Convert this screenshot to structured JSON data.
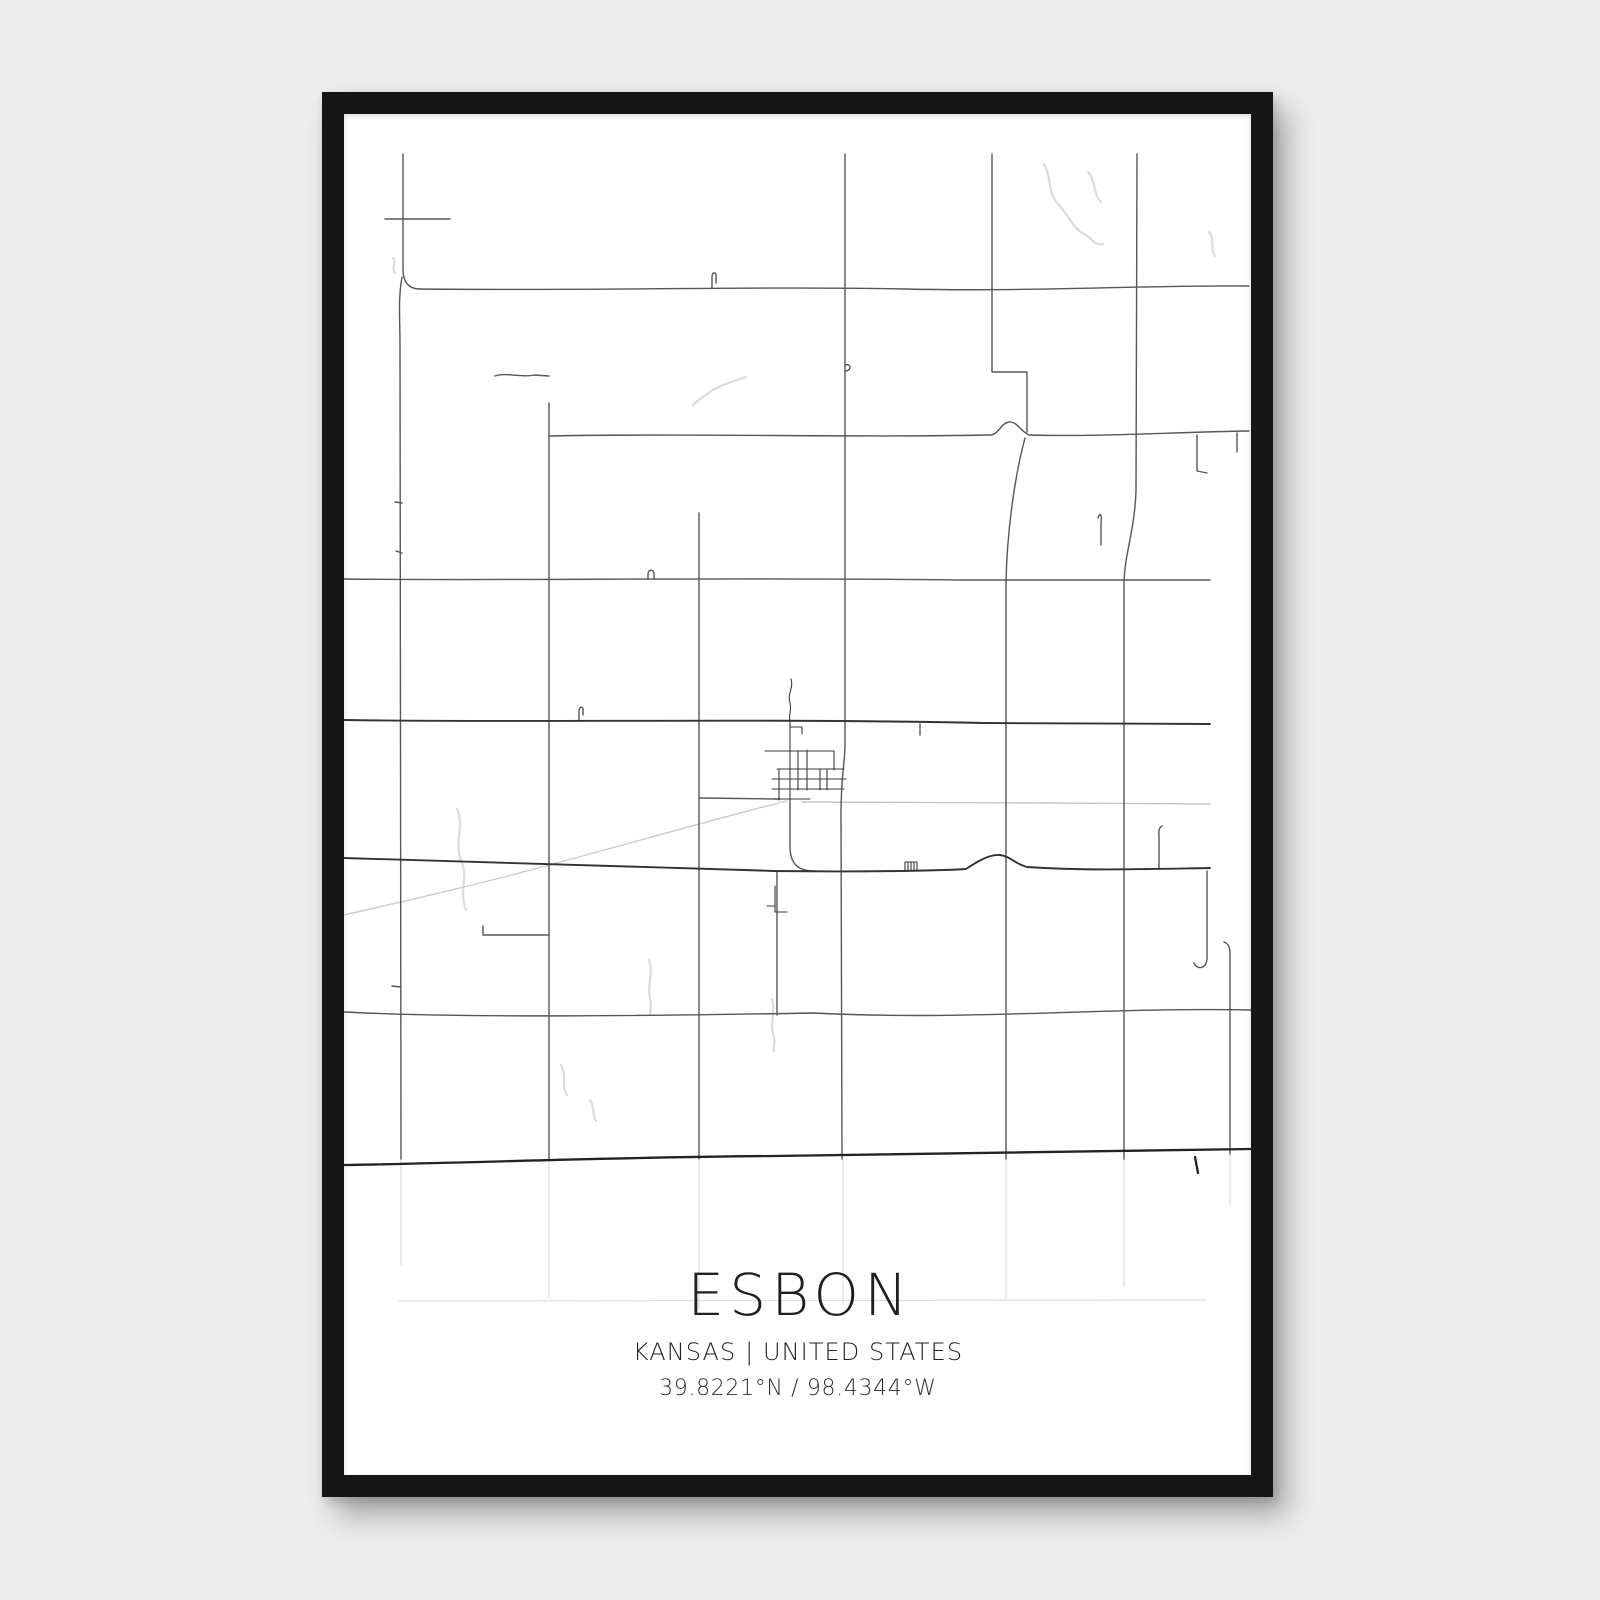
{
  "poster": {
    "title": "ESBON",
    "subtitle": "KANSAS | UNITED STATES",
    "coordinates": "39.8221°N / 98.4344°W"
  },
  "colors": {
    "background": "#ededed",
    "frame": "#161616",
    "print": "#ffffff",
    "text": "#1f1f1f",
    "road": "#565656",
    "road_major": "#232323",
    "road_minor": "#c6c6c6",
    "water": "#dbdbdb"
  },
  "map": {
    "width": 907,
    "height": 1361,
    "layers": [
      {
        "class": "water",
        "paths": [
          "M700,50 C708,64 703,78 714,90 C726,102 728,114 740,120 C748,124 750,132 759,130",
          "M744,58 C752,67 749,80 757,88",
          "M865,118 C871,125 866,135 871,142",
          "M349,291 C356,284 363,280 369,276 C381,269 391,267 402,263",
          "M113,695 C121,712 109,731 118,749 C124,762 115,779 122,796",
          "M428,885 C432,896 425,911 430,923 C432,929 428,933 430,937",
          "M305,846 C310,859 302,873 307,888 L306,901",
          "M217,951 C223,962 217,972 223,981",
          "M246,986 C251,993 248,1001 252,1007",
          "M49,144 C53,149 47,155 51,159"
        ]
      },
      {
        "class": "rail",
        "paths": [
          "M443,687 C380,702 260,737 160,763 C105,777 40,792 0,801"
        ]
      },
      {
        "class": "road-light",
        "paths": [
          "M458,688 L700,689 L866,690"
        ]
      },
      {
        "class": "faint",
        "paths": [
          "M57,1045 L57,1152",
          "M205,1045 L205,1183",
          "M355,1045 L355,1196",
          "M499,1045 L499,1190",
          "M662,1045 L662,1184",
          "M780,1045 L780,1172",
          "M55,1187 L862,1186",
          "M886,1040 L886,1092"
        ]
      },
      {
        "class": "road",
        "paths": [
          "M59,40 L59,155 Q59,175 76,175",
          "M58,163 C54,186 56,202 56,232 L57,1045",
          "M41,105 L106,105",
          "M76,175 C240,177 430,172 560,175 C690,178 800,171 905,172",
          "M205,289 L205,1045",
          "M151,262 C162,258 178,264 190,261 L205,262",
          "M355,399 L355,1045",
          "M205,322 C340,319 520,324 640,321 L647,321 C655,320 657,309 665,308 C673,307 677,318 685,321 C760,323 830,318 905,317",
          "M648,40 L648,258 L683,258 L683,318",
          "M681,324 C670,365 663,420 662,468 L662,1045",
          "M501,40 L501,630 C501,650 497,660 497,700 L498,1045",
          "M793,40 L792,378 C790,420 781,438 780,468 L780,1045",
          "M0,465 C150,467 390,463 620,466 L866,466",
          "M0,898 C120,904 300,902 470,899 C620,907 760,893 907,896",
          "M433,758 L433,901",
          "M853,321 L853,357 L863,359",
          "M893,319 L893,338",
          "M754,404 C756,398 758,400 757,409 L757,431",
          "M818,712 C814,714 815,719 815,724 L815,755",
          "M863,757 L863,844 C863,854 854,857 850,849",
          "M880,828 C885,830 886,834 886,840 L886,1040",
          "M139,812 L139,821 L205,821",
          "M368,174 L368,163 C368,157 373,158 372,163 L372,169",
          "M304,465 L304,460 C304,455 310,455 310,460 L310,465",
          "M235,606 L235,597 C235,592 240,592 239,597 L239,601",
          "M576,610 L576,621",
          "M501,251 C507,249 508,256 502,257",
          "M51,388 L58,389",
          "M52,437 L58,439",
          "M48,872 L57,873",
          "M356,684 L436,685",
          "M446,691 L446,732 C446,749 453,757 470,757"
        ]
      },
      {
        "class": "road2",
        "paths": [
          "M0,606 C180,609 400,604 640,609 L866,610",
          "M0,744 C100,747 250,752 400,756 L430,757 C510,758 590,757 622,755 C634,747 646,740 656,741 C666,742 671,750 683,753 C740,757 806,755 866,754"
        ]
      },
      {
        "class": "road-dark",
        "paths": [
          "M0,1051 C130,1049 270,1043 430,1042 C610,1039 770,1036 907,1035",
          "M851,1043 L854,1059"
        ]
      },
      {
        "class": "street",
        "paths": [
          "M447,565 C450,573 443,580 446,589 C448,597 444,601 446,607",
          "M446,607 L446,691",
          "M421,637 L490,637",
          "M433,655 L500,655",
          "M428,665 L502,665",
          "M428,675 L500,675",
          "M430,685 L466,685",
          "M435,655 L435,686",
          "M454,637 L454,676",
          "M463,636 L463,676",
          "M476,655 L476,676",
          "M490,637 L490,656",
          "M483,655 L483,676",
          "M446,613 L458,613 L458,620",
          "M431,772 L431,798 L443,798",
          "M423,792 L431,792",
          "M561,748 L573,748 M561,748 L561,756 M564,748 L564,756 M567,748 L567,756 M570,748 L570,756 M573,748 L573,756"
        ]
      }
    ]
  }
}
